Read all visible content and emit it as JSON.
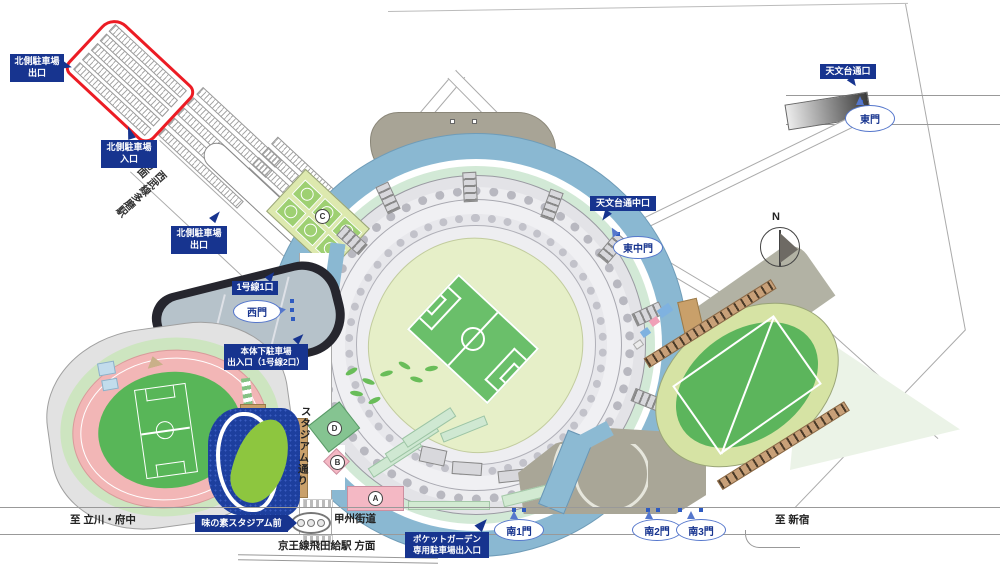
{
  "labels": {
    "north_parking_exit_top": "北側駐車場\n出口",
    "north_parking_entrance": "北側駐車場\n入口",
    "north_parking_exit_mid": "北側駐車場\n出口",
    "line1_gate1": "1号線1口",
    "under_stadium_parking": "本体下駐車場\n出入口（1号線2口）",
    "ajinomoto_stadium_mae": "味の素スタジアム前",
    "pocket_garden_parking": "ポケットガーデン\n専用駐車場出入口",
    "tenmondai_street_exit": "天文台通口",
    "tenmondai_street_mid_exit": "天文台通中口"
  },
  "gates": {
    "west": "西門",
    "east": "東門",
    "east_middle": "東中門",
    "south1": "南1門",
    "south2": "南2門",
    "south3": "南3門"
  },
  "roads": {
    "koshu_kaido": "甲州街道",
    "stadium_street": "スタジアム通り",
    "seibu_tama_station": "西武線多磨駅\n方面",
    "keio_tobitakyu": "京王線飛田給駅 方面",
    "to_tachikawa_fuchu": "至 立川・府中",
    "to_shinjuku": "至 新宿"
  },
  "zones": {
    "a": "A",
    "b": "B",
    "c": "C",
    "d": "D"
  },
  "compass": {
    "north": "N"
  },
  "colors": {
    "label_navy": "#17348f",
    "parking_outline_red": "#ec1c24",
    "ring_road_blue": "#8ab8d2",
    "mint_green": "#d2e9d6",
    "stadium_bowl": "#e6efc8",
    "pitch_green": "#6abf6a",
    "track_pink": "#f2b6b6",
    "infield_green": "#58b658",
    "leaf_green": "#8dc63f",
    "building_blue": "#1d3f9e",
    "deck_tan": "#c9a06a",
    "plaza_olive": "#a9a697",
    "court_green": "#9ed072",
    "zone_pink": "#f4b8c4",
    "zone_green": "#85c491",
    "gate_blue": "#4466cc"
  }
}
